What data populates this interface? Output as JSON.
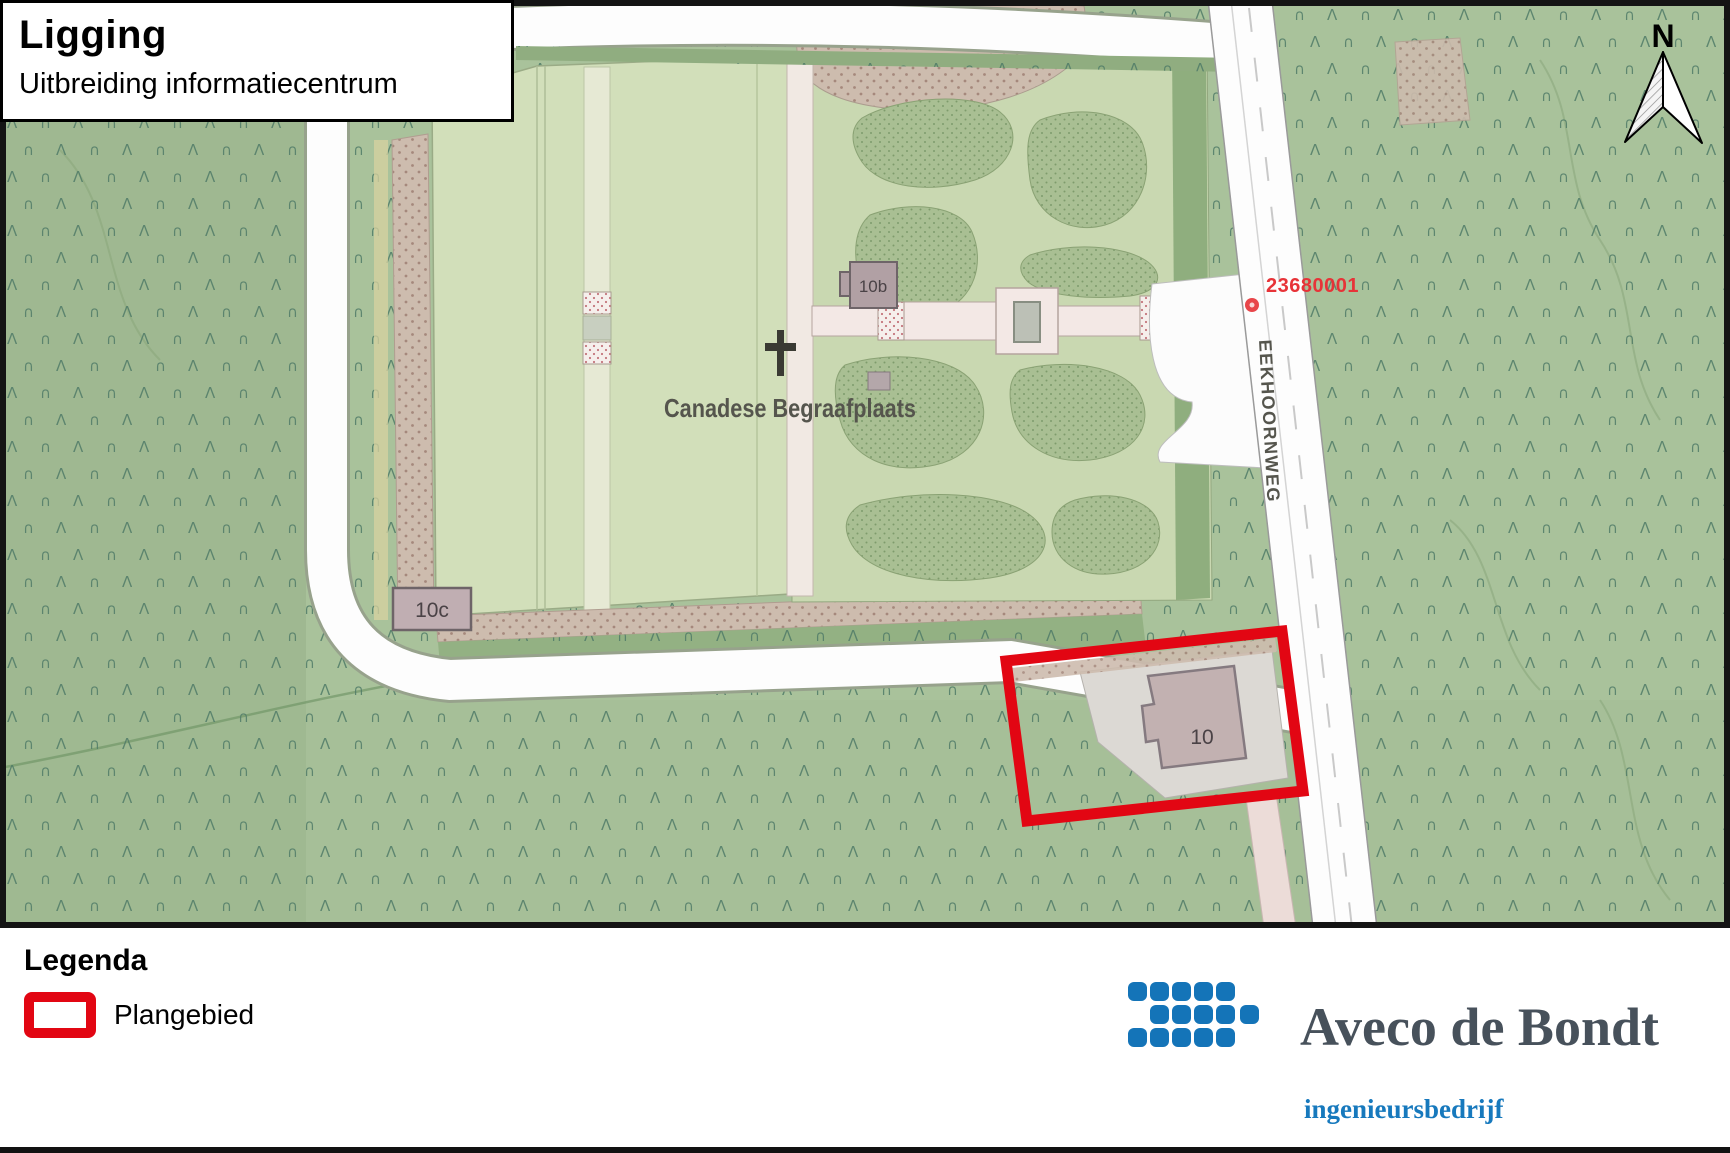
{
  "title_box": {
    "title": "Ligging",
    "subtitle": "Uitbreiding informatiecentrum"
  },
  "map": {
    "labels": {
      "cemetery": "Canadese Begraafplaats",
      "road": "EEKHOORNWEG",
      "reference_number": "23680001",
      "building_10b": "10b",
      "building_10c": "10c",
      "building_10": "10",
      "north_indicator": "N"
    },
    "colors": {
      "forest_green": "#a9c29b",
      "lawn_green": "#d2dfba",
      "tree_symbol": "#507b67",
      "plan_outline_red": "#e20613",
      "road_white": "#fdfdfd",
      "reference_red": "#e73338"
    }
  },
  "legend": {
    "heading": "Legenda",
    "items": [
      {
        "label": "Plangebied",
        "swatch_color": "#e20613"
      }
    ]
  },
  "branding": {
    "company": "Aveco de Bondt",
    "tagline": "ingenieursbedrijf",
    "brand_blue": "#1474b8",
    "brand_gray": "#47515b"
  }
}
